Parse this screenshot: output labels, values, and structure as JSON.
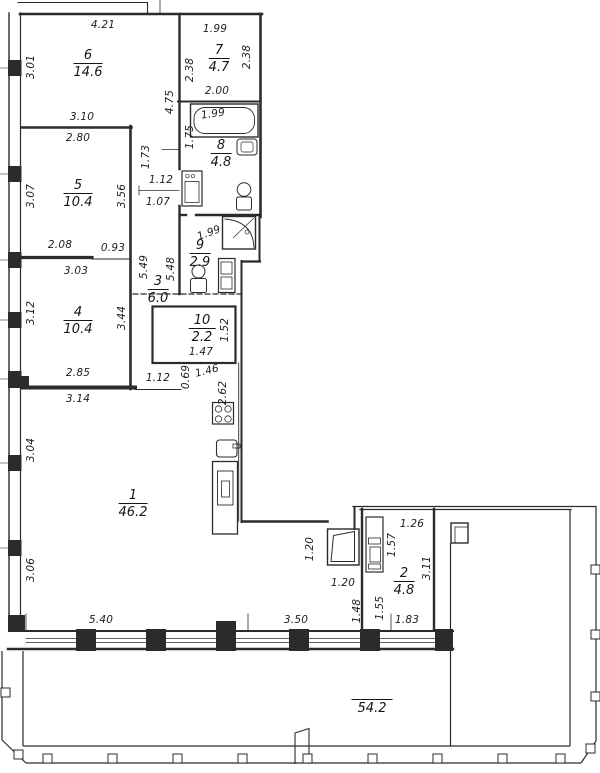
{
  "drawing": {
    "kind": "apartment floor plan",
    "background_color": "#ffffff",
    "line_color": "#2b2b2b",
    "units": "meters / square meters"
  },
  "rooms": [
    {
      "id": "room-6",
      "number": "6",
      "area": "14.6",
      "x": 88,
      "y": 49
    },
    {
      "id": "room-7",
      "number": "7",
      "area": "4.7",
      "x": 219,
      "y": 44
    },
    {
      "id": "room-8",
      "number": "8",
      "area": "4.8",
      "x": 221,
      "y": 139
    },
    {
      "id": "room-5",
      "number": "5",
      "area": "10.4",
      "x": 78,
      "y": 179
    },
    {
      "id": "room-9",
      "number": "9",
      "area": "2.9",
      "x": 200,
      "y": 239
    },
    {
      "id": "room-3",
      "number": "3",
      "area": "6.0",
      "x": 158,
      "y": 275
    },
    {
      "id": "room-4",
      "number": "4",
      "area": "10.4",
      "x": 78,
      "y": 306
    },
    {
      "id": "room-10",
      "number": "10",
      "area": "2.2",
      "x": 202,
      "y": 314
    },
    {
      "id": "room-1",
      "number": "1",
      "area": "46.2",
      "x": 133,
      "y": 489
    },
    {
      "id": "room-2",
      "number": "2",
      "area": "4.8",
      "x": 404,
      "y": 567
    }
  ],
  "terrace": {
    "area": "54.2",
    "x": 372,
    "y": 699
  },
  "dimensions": [
    {
      "text": "4.21",
      "x": 103,
      "y": 25,
      "r": 0
    },
    {
      "text": "1.99",
      "x": 215,
      "y": 29,
      "r": 0
    },
    {
      "text": "3.01",
      "x": 31,
      "y": 67,
      "r": -90
    },
    {
      "text": "2.38",
      "x": 190,
      "y": 70,
      "r": -90
    },
    {
      "text": "2.38",
      "x": 247,
      "y": 57,
      "r": -90
    },
    {
      "text": "2.00",
      "x": 217,
      "y": 91,
      "r": 0
    },
    {
      "text": "3.10",
      "x": 82,
      "y": 117,
      "r": 0
    },
    {
      "text": "2.80",
      "x": 78,
      "y": 138,
      "r": 0
    },
    {
      "text": "4.75",
      "x": 170,
      "y": 102,
      "r": -90
    },
    {
      "text": "1.75",
      "x": 190,
      "y": 137,
      "r": -90
    },
    {
      "text": "1.73",
      "x": 146,
      "y": 157,
      "r": -90
    },
    {
      "text": "1.99",
      "x": 213,
      "y": 114,
      "r": -8
    },
    {
      "text": "1.12",
      "x": 161,
      "y": 180,
      "r": 0
    },
    {
      "text": "1.07",
      "x": 158,
      "y": 202,
      "r": 0
    },
    {
      "text": "3.07",
      "x": 31,
      "y": 196,
      "r": -90
    },
    {
      "text": "3.56",
      "x": 122,
      "y": 196,
      "r": -90
    },
    {
      "text": "2.08",
      "x": 60,
      "y": 245,
      "r": 0
    },
    {
      "text": "0.93",
      "x": 113,
      "y": 248,
      "r": 0
    },
    {
      "text": "1.99",
      "x": 209,
      "y": 233,
      "r": -20
    },
    {
      "text": "3.03",
      "x": 76,
      "y": 271,
      "r": 0
    },
    {
      "text": "5.49",
      "x": 144,
      "y": 267,
      "r": -90
    },
    {
      "text": "5.48",
      "x": 171,
      "y": 269,
      "r": -90
    },
    {
      "text": "3.12",
      "x": 31,
      "y": 313,
      "r": -90
    },
    {
      "text": "3.44",
      "x": 122,
      "y": 318,
      "r": -90
    },
    {
      "text": "1.52",
      "x": 225,
      "y": 330,
      "r": -90
    },
    {
      "text": "1.47",
      "x": 201,
      "y": 352,
      "r": 0
    },
    {
      "text": "2.85",
      "x": 78,
      "y": 373,
      "r": 0
    },
    {
      "text": "1.12",
      "x": 158,
      "y": 378,
      "r": 0
    },
    {
      "text": "3.14",
      "x": 78,
      "y": 399,
      "r": 0
    },
    {
      "text": "0.69",
      "x": 186,
      "y": 377,
      "r": -90
    },
    {
      "text": "1.46",
      "x": 207,
      "y": 371,
      "r": -14
    },
    {
      "text": "2.62",
      "x": 223,
      "y": 393,
      "r": -90
    },
    {
      "text": "3.04",
      "x": 31,
      "y": 450,
      "r": -90
    },
    {
      "text": "3.06",
      "x": 31,
      "y": 570,
      "r": -90
    },
    {
      "text": "1.20",
      "x": 310,
      "y": 549,
      "r": -90
    },
    {
      "text": "1.20",
      "x": 343,
      "y": 583,
      "r": 0
    },
    {
      "text": "1.26",
      "x": 412,
      "y": 524,
      "r": 0
    },
    {
      "text": "1.57",
      "x": 392,
      "y": 545,
      "r": -90
    },
    {
      "text": "3.11",
      "x": 427,
      "y": 568,
      "r": -90
    },
    {
      "text": "1.48",
      "x": 357,
      "y": 611,
      "r": -90
    },
    {
      "text": "1.55",
      "x": 380,
      "y": 608,
      "r": -90
    },
    {
      "text": "1.83",
      "x": 407,
      "y": 620,
      "r": 0
    },
    {
      "text": "5.40",
      "x": 101,
      "y": 620,
      "r": 0
    },
    {
      "text": "3.50",
      "x": 296,
      "y": 620,
      "r": 0
    }
  ]
}
